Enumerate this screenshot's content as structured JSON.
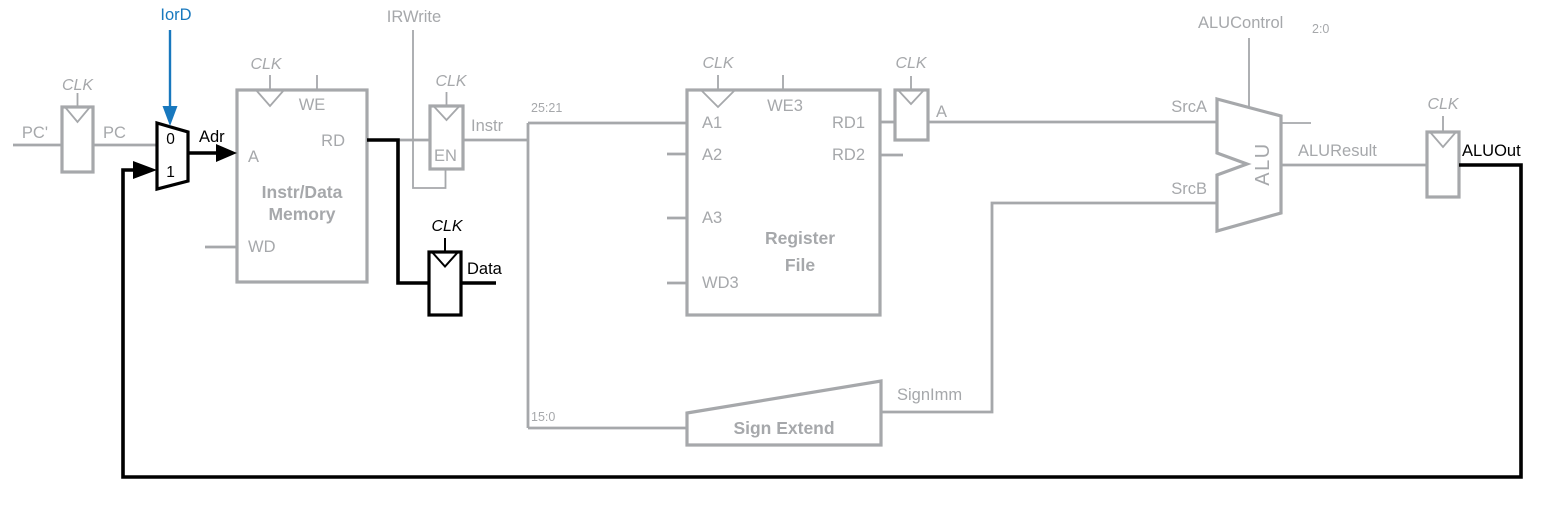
{
  "figure": {
    "type": "processor-datapath-diagram",
    "colors": {
      "active_path": "#000000",
      "inactive_path": "#a6a8ab",
      "control_signal": "#1878be"
    },
    "clock_label": "CLK",
    "pc_register": {
      "input_label": "PC'",
      "output_label": "PC"
    },
    "iord_mux": {
      "control_label": "IorD",
      "input0": "0",
      "input1": "1",
      "output_label": "Adr"
    },
    "memory": {
      "title_line1": "Instr/Data",
      "title_line2": "Memory",
      "ports": {
        "we": "WE",
        "a": "A",
        "rd": "RD",
        "wd": "WD"
      }
    },
    "instr_register": {
      "enable_port": "EN",
      "control_label": "IRWrite",
      "output_label": "Instr"
    },
    "data_register": {
      "output_label": "Data"
    },
    "instr_fields": {
      "high": "25:21",
      "low": "15:0"
    },
    "register_file": {
      "title_line1": "Register",
      "title_line2": "File",
      "ports": {
        "a1": "A1",
        "a2": "A2",
        "a3": "A3",
        "wd3": "WD3",
        "we3": "WE3",
        "rd1": "RD1",
        "rd2": "RD2"
      }
    },
    "a_register": {
      "output_label": "A"
    },
    "sign_extend": {
      "title": "Sign Extend",
      "output_label": "SignImm"
    },
    "alu": {
      "label": "ALU",
      "control_label": "ALUControl",
      "control_subscript": "2:0",
      "input_a": "SrcA",
      "input_b": "SrcB",
      "output_label": "ALUResult"
    },
    "aluout_register": {
      "output_label": "ALUOut"
    }
  }
}
